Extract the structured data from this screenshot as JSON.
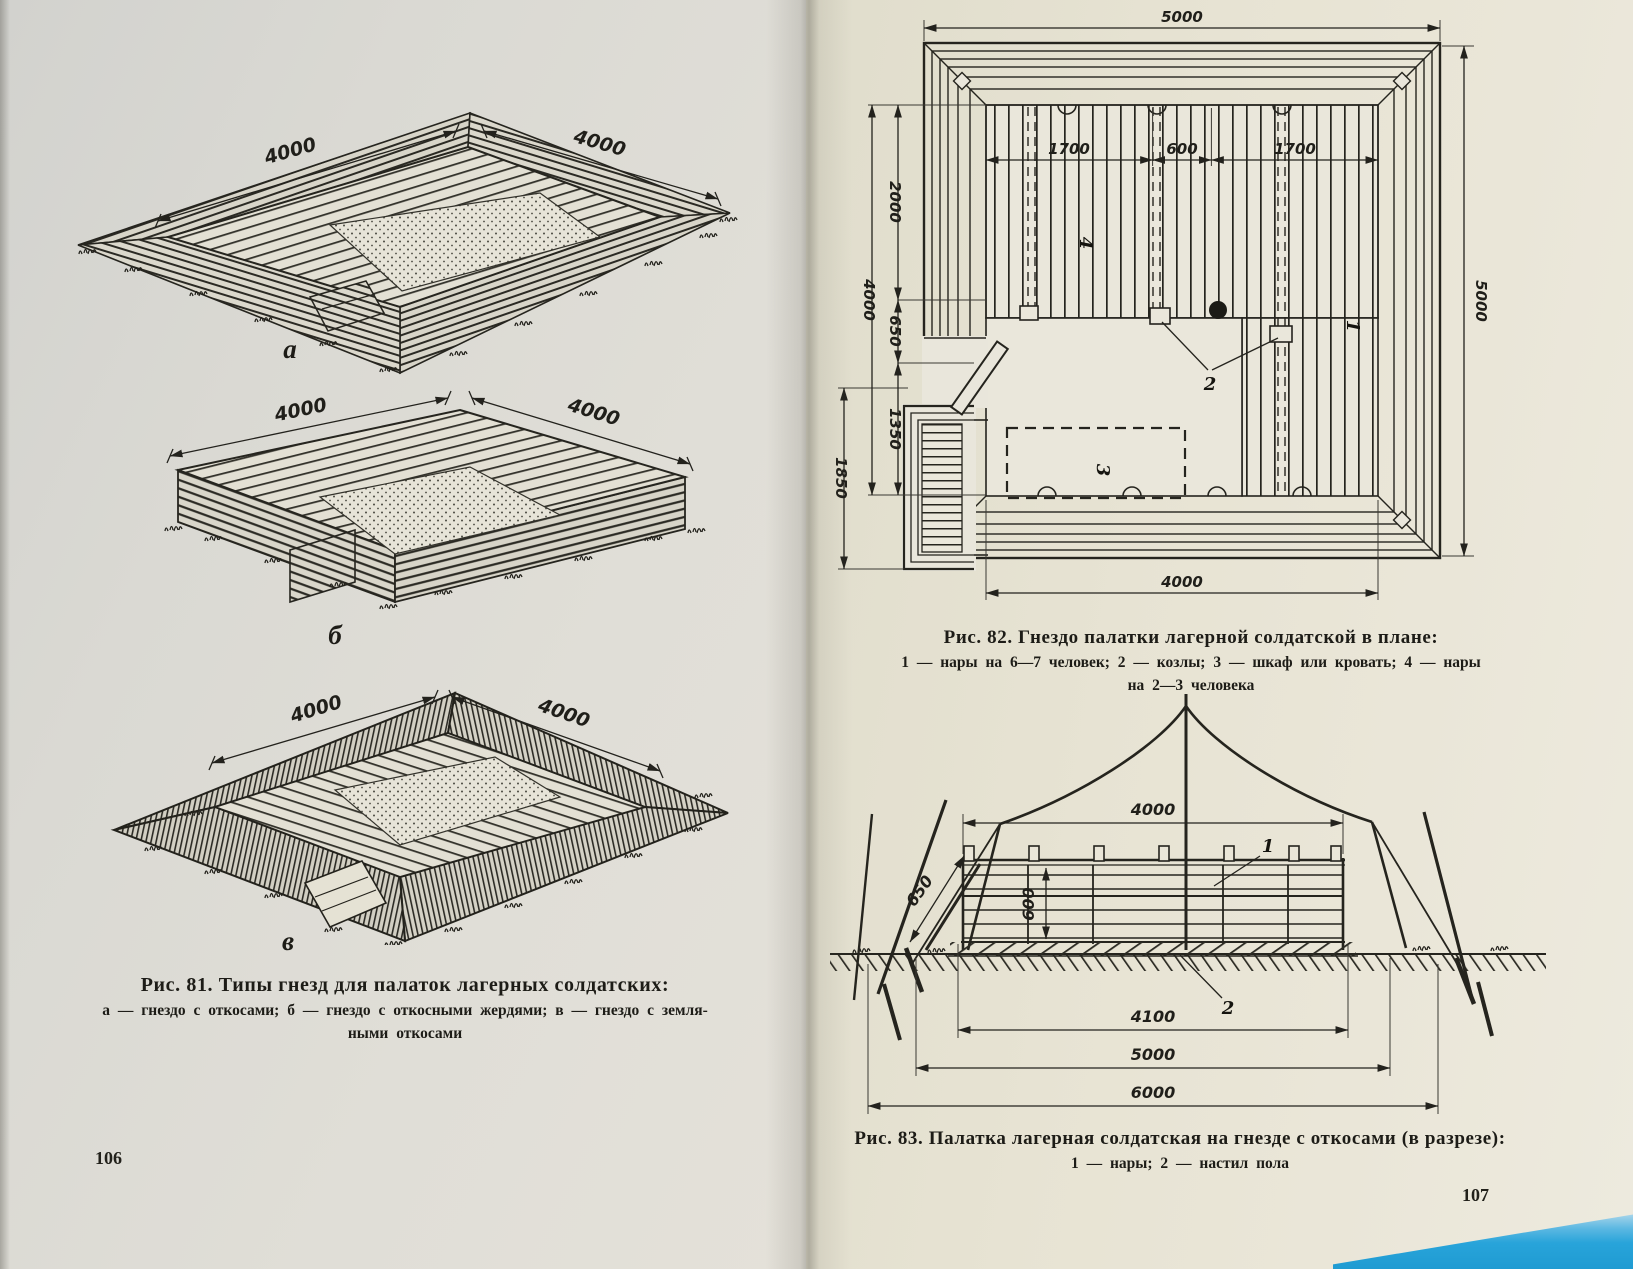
{
  "left_page": {
    "page_number": "106",
    "figure": {
      "title": "Рис. 81. Типы гнезд для палаток лагерных солдатских:",
      "legend_line1": "а — гнездо с откосами;  б — гнездо с откосными жердями;  в — гнездо с земля-",
      "legend_line2": "ными  откосами",
      "drawing_a": {
        "letter": "а",
        "dim_left": "4000",
        "dim_right": "4000"
      },
      "drawing_b": {
        "letter": "б",
        "dim_left": "4000",
        "dim_right": "4000"
      },
      "drawing_v": {
        "letter": "в",
        "dim_left": "4000",
        "dim_right": "4000"
      }
    }
  },
  "right_page": {
    "page_number": "107",
    "figure_plan": {
      "title": "Рис. 82. Гнездо палатки лагерной солдатской в плане:",
      "legend_line1": "1 — нары  на  6—7 человек;  2 — козлы;  3 — шкаф  или  кровать;  4 — нары",
      "legend_line2": "на 2—3 человека",
      "dims": {
        "top_width": "5000",
        "right_height": "5000",
        "seg_left": "1700",
        "seg_center": "600",
        "seg_right": "1700",
        "left_upper": "2000",
        "left_total": "4000",
        "left_middle": "650",
        "left_lower": "1350",
        "left_outer": "1850",
        "bottom_width": "4000"
      },
      "labels": {
        "bunks_main": "1",
        "trestles": "2",
        "cabinet": "3",
        "bunks_small": "4"
      }
    },
    "figure_section": {
      "title": "Рис. 83. Палатка лагерная солдатская на гнезде с откосами (в разрезе):",
      "legend": "1 — нары;  2 — настил  пола",
      "dims": {
        "bunk_width": "4000",
        "bunk_height": "600",
        "slope": "650",
        "floor_width": "4100",
        "nest_width": "5000",
        "tent_span": "6000"
      },
      "labels": {
        "bunks": "1",
        "floor": "2"
      }
    }
  },
  "colors": {
    "paper_left": "#dfddd6",
    "paper_right": "#eae6d8",
    "ink": "#23221d",
    "table_blue": "#2aa7dd"
  }
}
